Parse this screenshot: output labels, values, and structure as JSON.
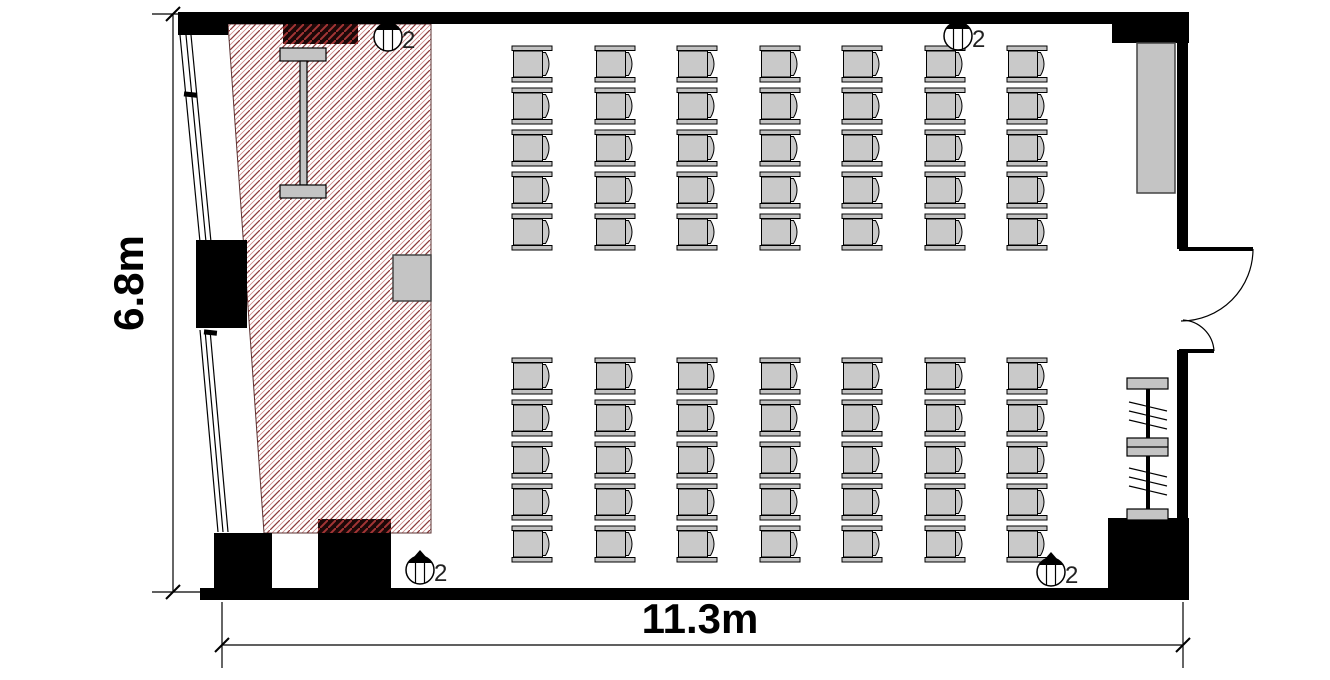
{
  "drawing": {
    "type": "seminar-room-floor-plan",
    "room_width_label": "11.3m",
    "room_depth_label": "6.8m"
  },
  "outlets": {
    "label": "2",
    "positions": [
      {
        "cx": 388,
        "cy": 37,
        "location": "top-left-wall"
      },
      {
        "cx": 958,
        "cy": 36,
        "location": "top-right-wall"
      },
      {
        "cx": 420,
        "cy": 570,
        "location": "bottom-left-wall"
      },
      {
        "cx": 1051,
        "cy": 572,
        "location": "bottom-right-wall"
      }
    ]
  },
  "seating": {
    "chair_width": 40,
    "chair_height": 36,
    "seat_color": "#c9c9c9",
    "bar_color": "#c2c2c2",
    "facing": "left",
    "blocks": [
      {
        "name": "front-block",
        "col_x": [
          512,
          595,
          677,
          760,
          842,
          925,
          1007
        ],
        "row_y": [
          46,
          88,
          130,
          172,
          214
        ]
      },
      {
        "name": "rear-block",
        "col_x": [
          512,
          595,
          677,
          760,
          842,
          925,
          1007
        ],
        "row_y": [
          358,
          400,
          442,
          484,
          526
        ]
      }
    ],
    "total_chairs": 70
  },
  "features": {
    "stage_area": "hatched",
    "steel_column": "I-beam",
    "door": "unequal-double-leaf-outswing",
    "coat_rack": true,
    "wall_screen": true,
    "podium": true
  },
  "colors": {
    "wall": "#000000",
    "hatch_line_dark": "#8b3a3a",
    "hatch_line_light": "#cf8a8a",
    "furniture_gray": "#c4c4c4",
    "dark_block": "#1c0808"
  }
}
